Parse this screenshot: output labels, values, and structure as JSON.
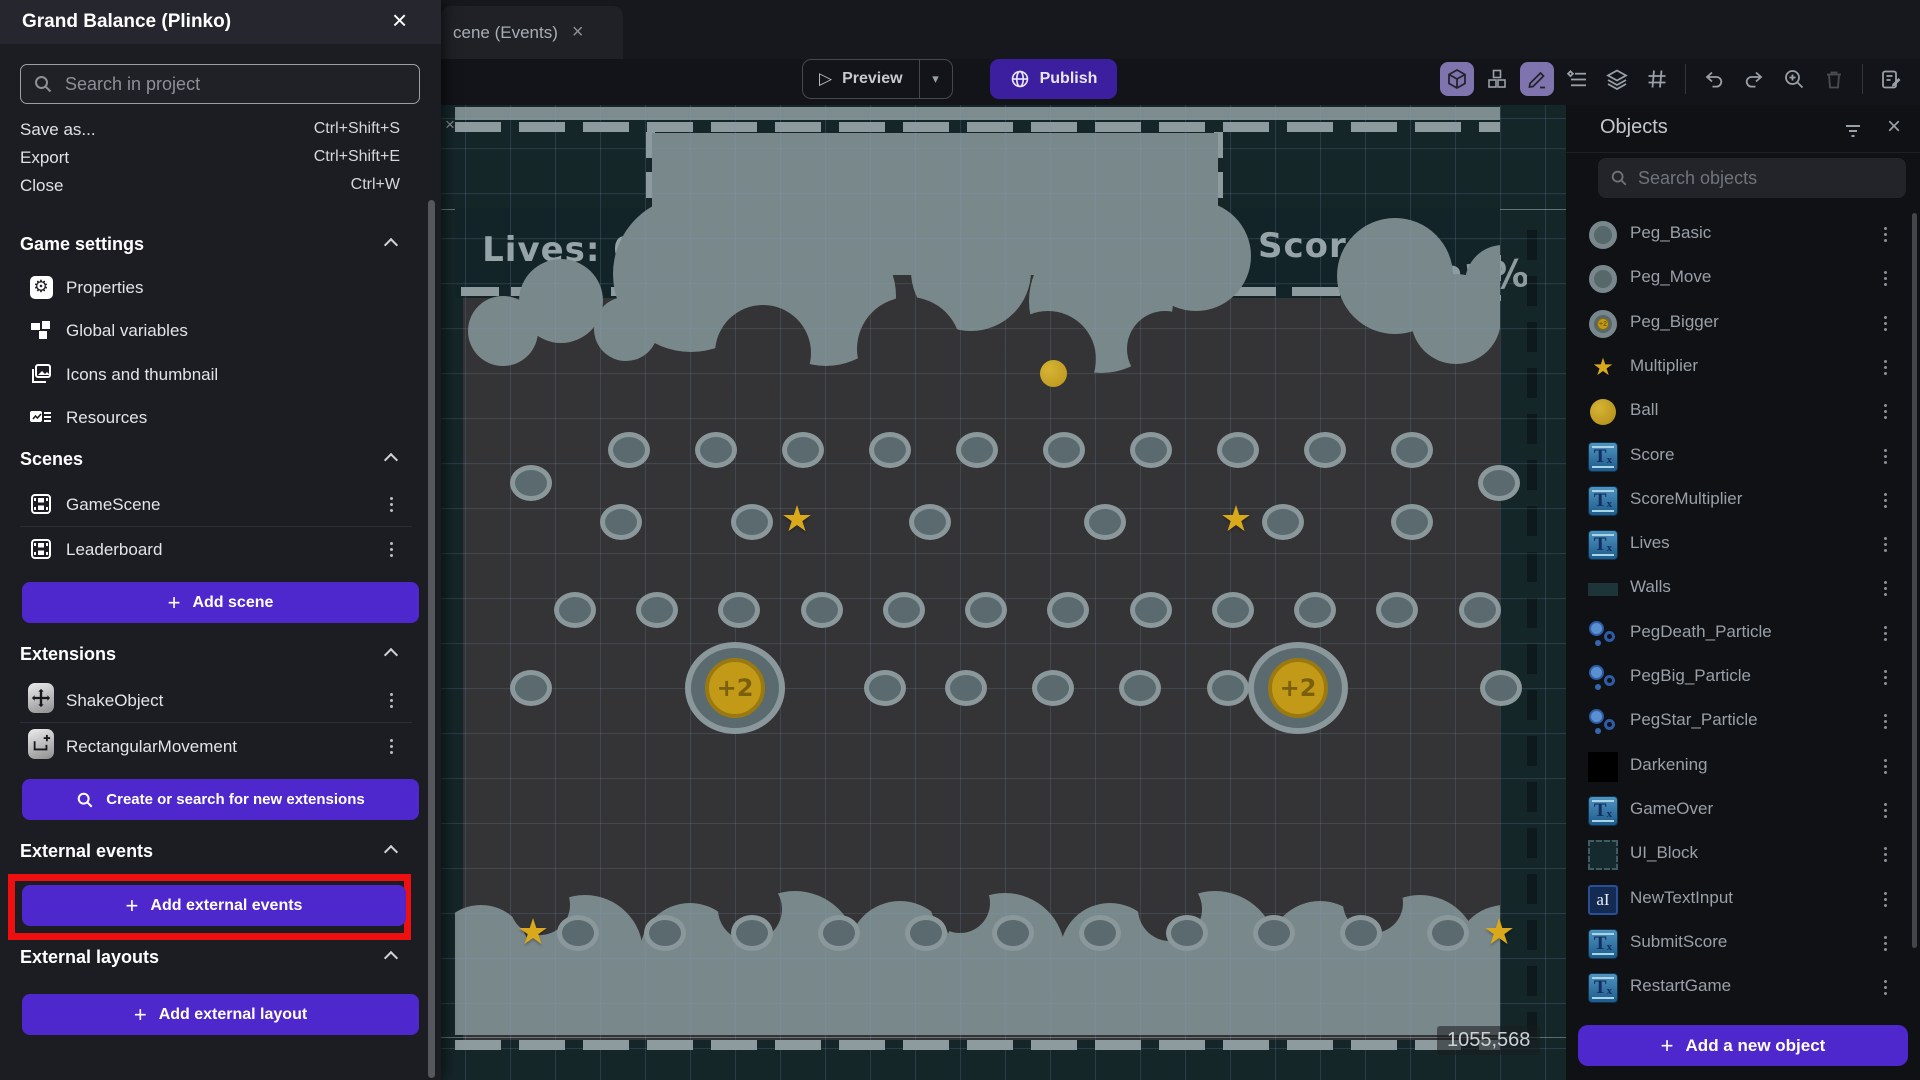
{
  "window": {
    "tab_label": "cene (Events)",
    "tab_close": "×",
    "canvas_corner_close": "×"
  },
  "toolbar": {
    "preview_label": "Preview",
    "publish_label": "Publish"
  },
  "project_menu": {
    "title": "Grand Balance (Plinko)",
    "close_icon": "×",
    "search_placeholder": "Search in project",
    "menu_items": [
      {
        "label": "Save as...",
        "shortcut": "Ctrl+Shift+S"
      },
      {
        "label": "Export",
        "shortcut": "Ctrl+Shift+E"
      },
      {
        "label": "Close",
        "shortcut": "Ctrl+W"
      }
    ],
    "game_settings": {
      "label": "Game settings",
      "items": [
        "Properties",
        "Global variables",
        "Icons and thumbnail",
        "Resources"
      ]
    },
    "scenes": {
      "label": "Scenes",
      "items": [
        "GameScene",
        "Leaderboard"
      ],
      "add_label": "Add scene"
    },
    "extensions": {
      "label": "Extensions",
      "items": [
        "ShakeObject",
        "RectangularMovement"
      ],
      "search_label": "Create or search for new extensions"
    },
    "external_events": {
      "label": "External events",
      "add_label": "Add external events"
    },
    "external_layouts": {
      "label": "External layouts",
      "add_label": "Add external layout"
    }
  },
  "objects_panel": {
    "title": "Objects",
    "search_placeholder": "Search objects",
    "add_label": "Add a new object",
    "items": [
      {
        "name": "Peg_Basic",
        "icon": "peg"
      },
      {
        "name": "Peg_Move",
        "icon": "peg"
      },
      {
        "name": "Peg_Bigger",
        "icon": "peg-big"
      },
      {
        "name": "Multiplier",
        "icon": "star"
      },
      {
        "name": "Ball",
        "icon": "ball"
      },
      {
        "name": "Score",
        "icon": "text"
      },
      {
        "name": "ScoreMultiplier",
        "icon": "text"
      },
      {
        "name": "Lives",
        "icon": "text"
      },
      {
        "name": "Walls",
        "icon": "walls"
      },
      {
        "name": "PegDeath_Particle",
        "icon": "particle"
      },
      {
        "name": "PegBig_Particle",
        "icon": "particle"
      },
      {
        "name": "PegStar_Particle",
        "icon": "particle"
      },
      {
        "name": "Darkening",
        "icon": "black"
      },
      {
        "name": "GameOver",
        "icon": "text"
      },
      {
        "name": "UI_Block",
        "icon": "uiblock"
      },
      {
        "name": "NewTextInput",
        "icon": "textinput"
      },
      {
        "name": "SubmitScore",
        "icon": "text"
      },
      {
        "name": "RestartGame",
        "icon": "text"
      }
    ]
  },
  "canvas": {
    "lives_label": "Lives: 0",
    "score_label": "Score: 0",
    "multiplier_label": "+25%",
    "cursor_coordinates": "1055,568",
    "coin_label": "+2",
    "pegs": [
      [
        188,
        345
      ],
      [
        275,
        345
      ],
      [
        362,
        345
      ],
      [
        449,
        345
      ],
      [
        536,
        345
      ],
      [
        623,
        345
      ],
      [
        710,
        345
      ],
      [
        797,
        345
      ],
      [
        884,
        345
      ],
      [
        971,
        345
      ],
      [
        90,
        378
      ],
      [
        1058,
        378
      ],
      [
        180,
        417
      ],
      [
        311,
        417
      ],
      [
        489,
        417
      ],
      [
        664,
        417
      ],
      [
        842,
        417
      ],
      [
        971,
        417
      ],
      [
        134,
        505
      ],
      [
        216,
        505
      ],
      [
        298,
        505
      ],
      [
        381,
        505
      ],
      [
        463,
        505
      ],
      [
        545,
        505
      ],
      [
        627,
        505
      ],
      [
        710,
        505
      ],
      [
        792,
        505
      ],
      [
        874,
        505
      ],
      [
        956,
        505
      ],
      [
        1039,
        505
      ],
      [
        90,
        583
      ],
      [
        444,
        583
      ],
      [
        525,
        583
      ],
      [
        612,
        583
      ],
      [
        699,
        583
      ],
      [
        787,
        583
      ],
      [
        1060,
        583
      ],
      [
        137,
        828
      ],
      [
        224,
        828
      ],
      [
        311,
        828
      ],
      [
        398,
        828
      ],
      [
        485,
        828
      ],
      [
        572,
        828
      ],
      [
        659,
        828
      ],
      [
        746,
        828
      ],
      [
        833,
        828
      ],
      [
        920,
        828
      ],
      [
        1007,
        828
      ]
    ],
    "stars": [
      [
        356,
        415
      ],
      [
        795,
        415
      ],
      [
        92,
        828
      ],
      [
        1058,
        828
      ]
    ],
    "coins": [
      [
        294,
        583
      ],
      [
        857,
        583
      ]
    ],
    "ball": [
      612,
      268
    ]
  },
  "colors": {
    "accent_purple": "#4f28cd",
    "publish_purple": "#3b1f9e",
    "highlight_red": "#ee1010",
    "canvas_teal": "#152629",
    "play_area": "#343335",
    "cloud_grey": "#79888b",
    "gold": "#c9a21e"
  }
}
